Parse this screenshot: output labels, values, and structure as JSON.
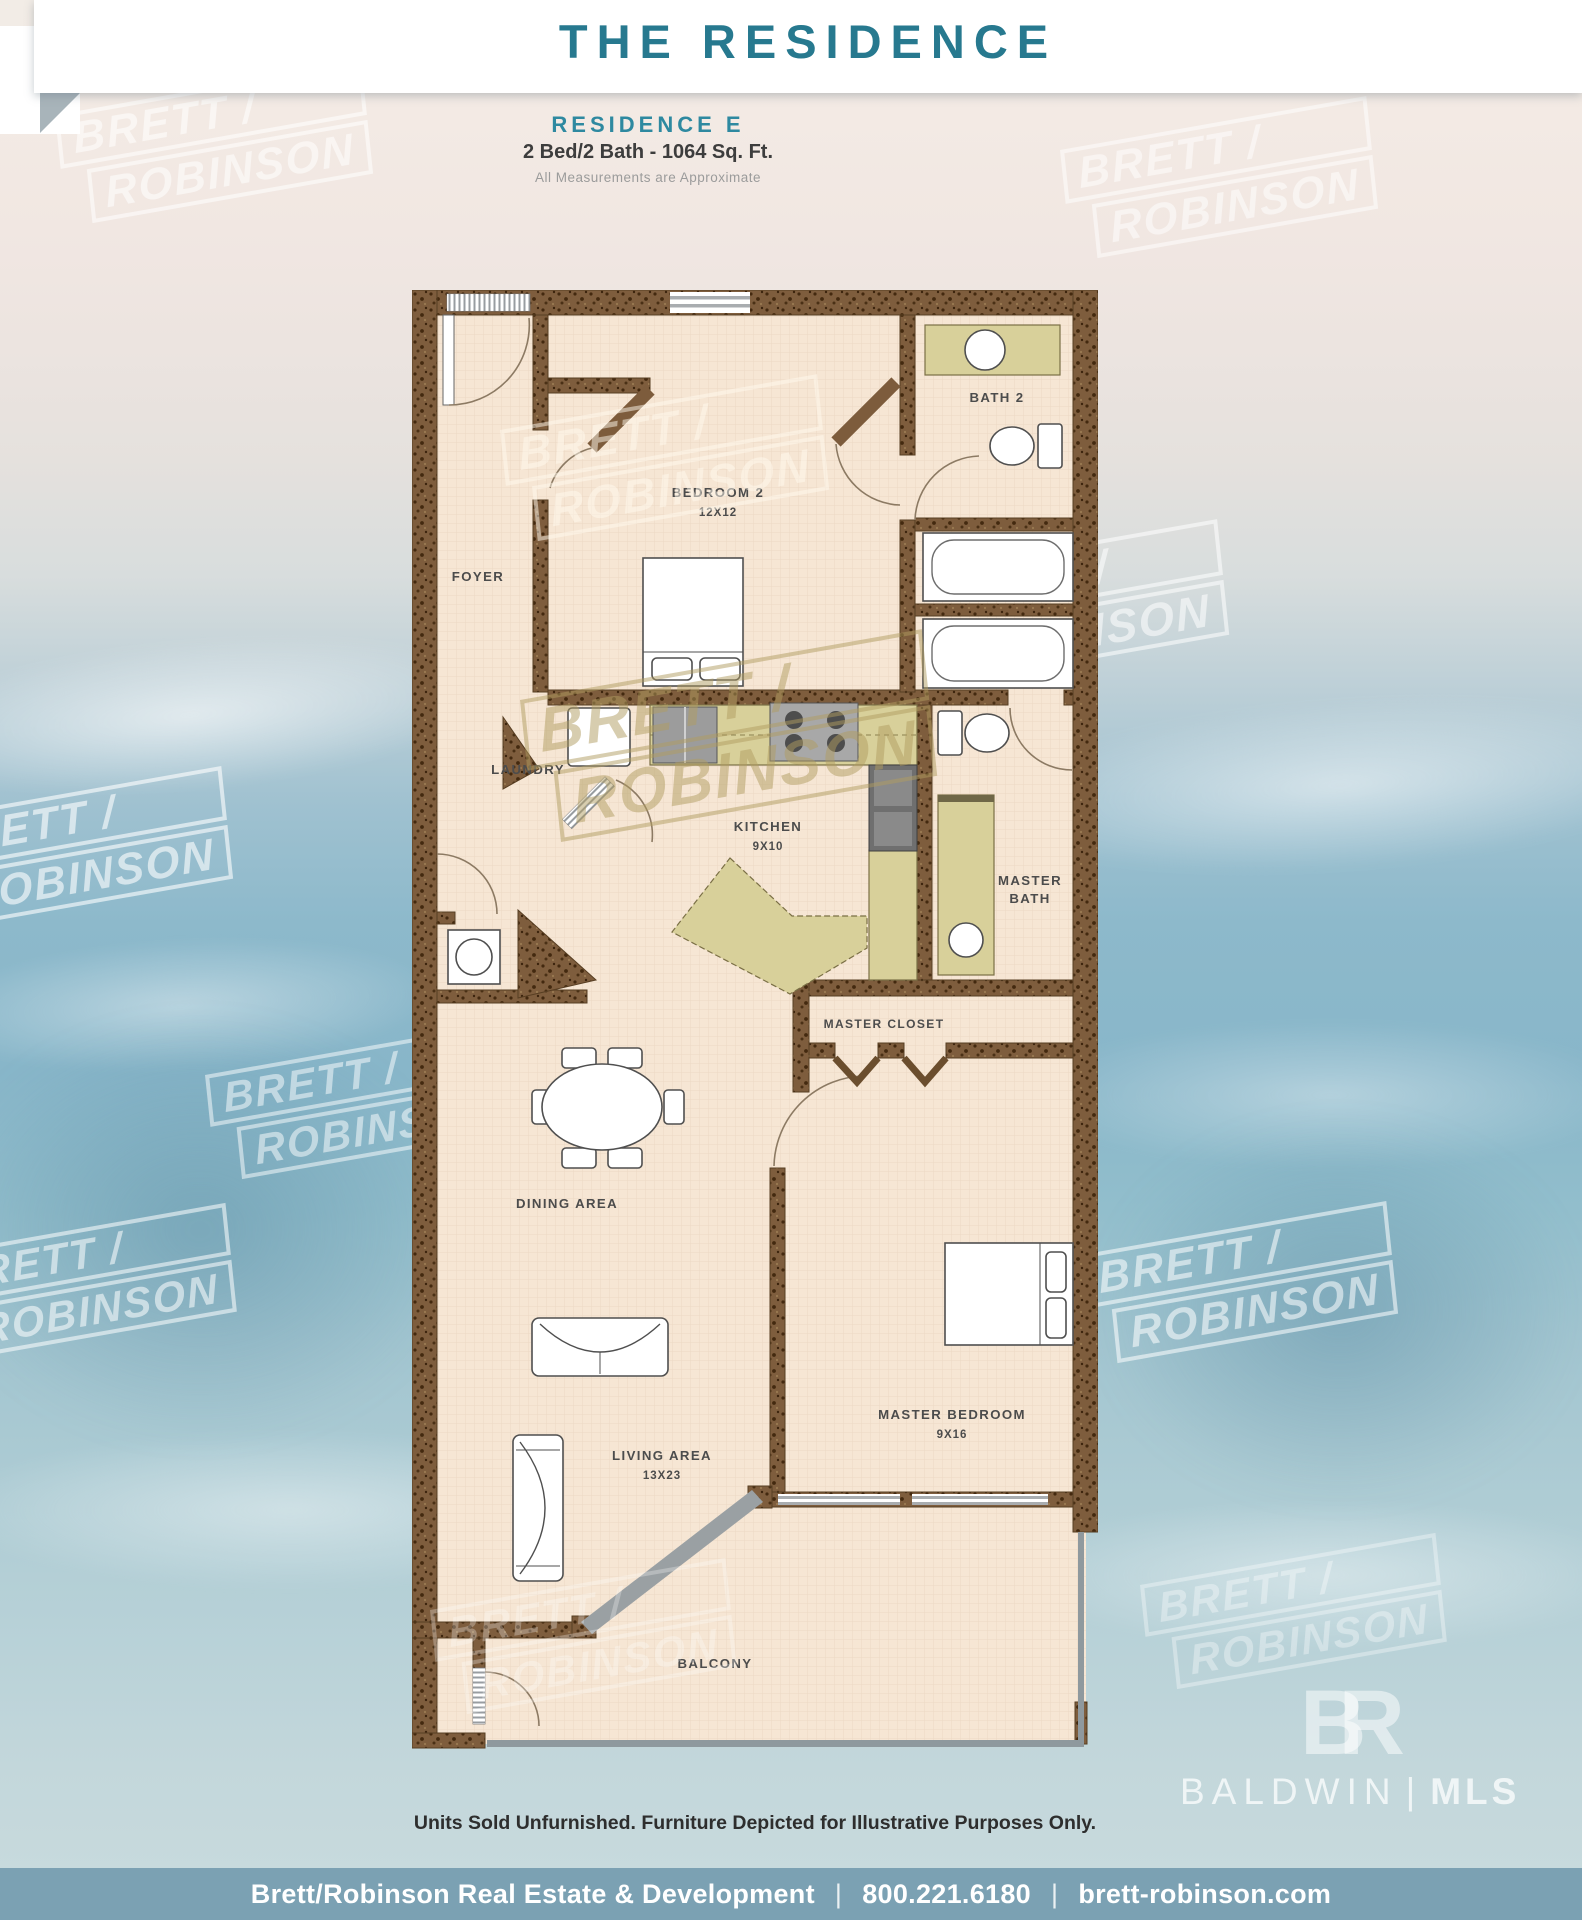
{
  "header": {
    "banner_title": "THE RESIDENCE",
    "residence_name": "RESIDENCE E",
    "specs": "2 Bed/2 Bath - 1064 Sq. Ft.",
    "note": "All Measurements are Approximate"
  },
  "watermark": {
    "line1": "BRETT /",
    "line2": "ROBINSON"
  },
  "plan": {
    "rooms": {
      "foyer": "FOYER",
      "bedroom2": "BEDROOM 2",
      "bedroom2_dim": "12X12",
      "bath2": "BATH 2",
      "laundry": "LAUNDRY",
      "kitchen": "KITCHEN",
      "kitchen_dim": "9X10",
      "master_bath_line1": "MASTER",
      "master_bath_line2": "BATH",
      "master_closet": "MASTER CLOSET",
      "dining": "DINING AREA",
      "living": "LIVING AREA",
      "living_dim": "13X23",
      "master_bedroom": "MASTER BEDROOM",
      "master_bedroom_dim": "9X16",
      "balcony": "BALCONY"
    }
  },
  "footer": {
    "disclaimer": "Units Sold Unfurnished. Furniture Depicted for Illustrative Purposes Only.",
    "company": "Brett/Robinson Real Estate & Development",
    "phone": "800.221.6180",
    "website": "brett-robinson.com",
    "separator": "|"
  },
  "logo": {
    "monogram": "BR",
    "name": "BALDWIN",
    "divider": "|",
    "suffix": "MLS"
  },
  "colors": {
    "accent_teal": "#27798f",
    "wall_brown": "#7d5c3c",
    "counter_khaki": "#d8d09a",
    "floor_tan": "#f6e6d4",
    "footer_bar": "#7ba1b3",
    "ocean_blue": "#8cb8cb"
  }
}
